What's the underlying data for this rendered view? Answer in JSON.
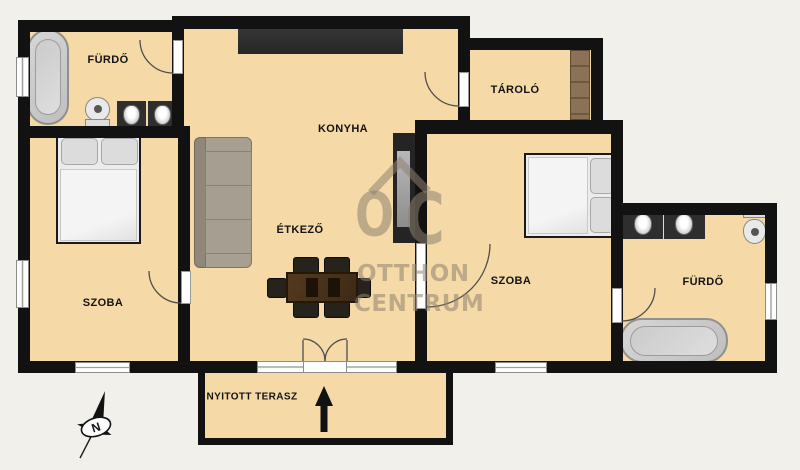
{
  "rooms": [
    {
      "id": "bathroom-left",
      "label": "FÜRDŐ"
    },
    {
      "id": "bedroom-left",
      "label": "SZOBA"
    },
    {
      "id": "kitchen",
      "label": "KONYHA"
    },
    {
      "id": "dining",
      "label": "ÉTKEZŐ"
    },
    {
      "id": "storage",
      "label": "TÁROLÓ"
    },
    {
      "id": "bedroom-right",
      "label": "SZOBA"
    },
    {
      "id": "bathroom-right",
      "label": "FÜRDŐ"
    },
    {
      "id": "terrace",
      "label": "NYITOTT TERASZ"
    }
  ],
  "watermark": {
    "o": "O",
    "c": "C",
    "line1": "OTTHON",
    "line2": "CENTRUM"
  },
  "compass": {
    "north": "N"
  },
  "colors": {
    "background": "#f2f0eb",
    "floor": "#f5d9a7",
    "wall": "#121212",
    "counter": "#2e2e2e",
    "watermark": "#8f8270"
  }
}
